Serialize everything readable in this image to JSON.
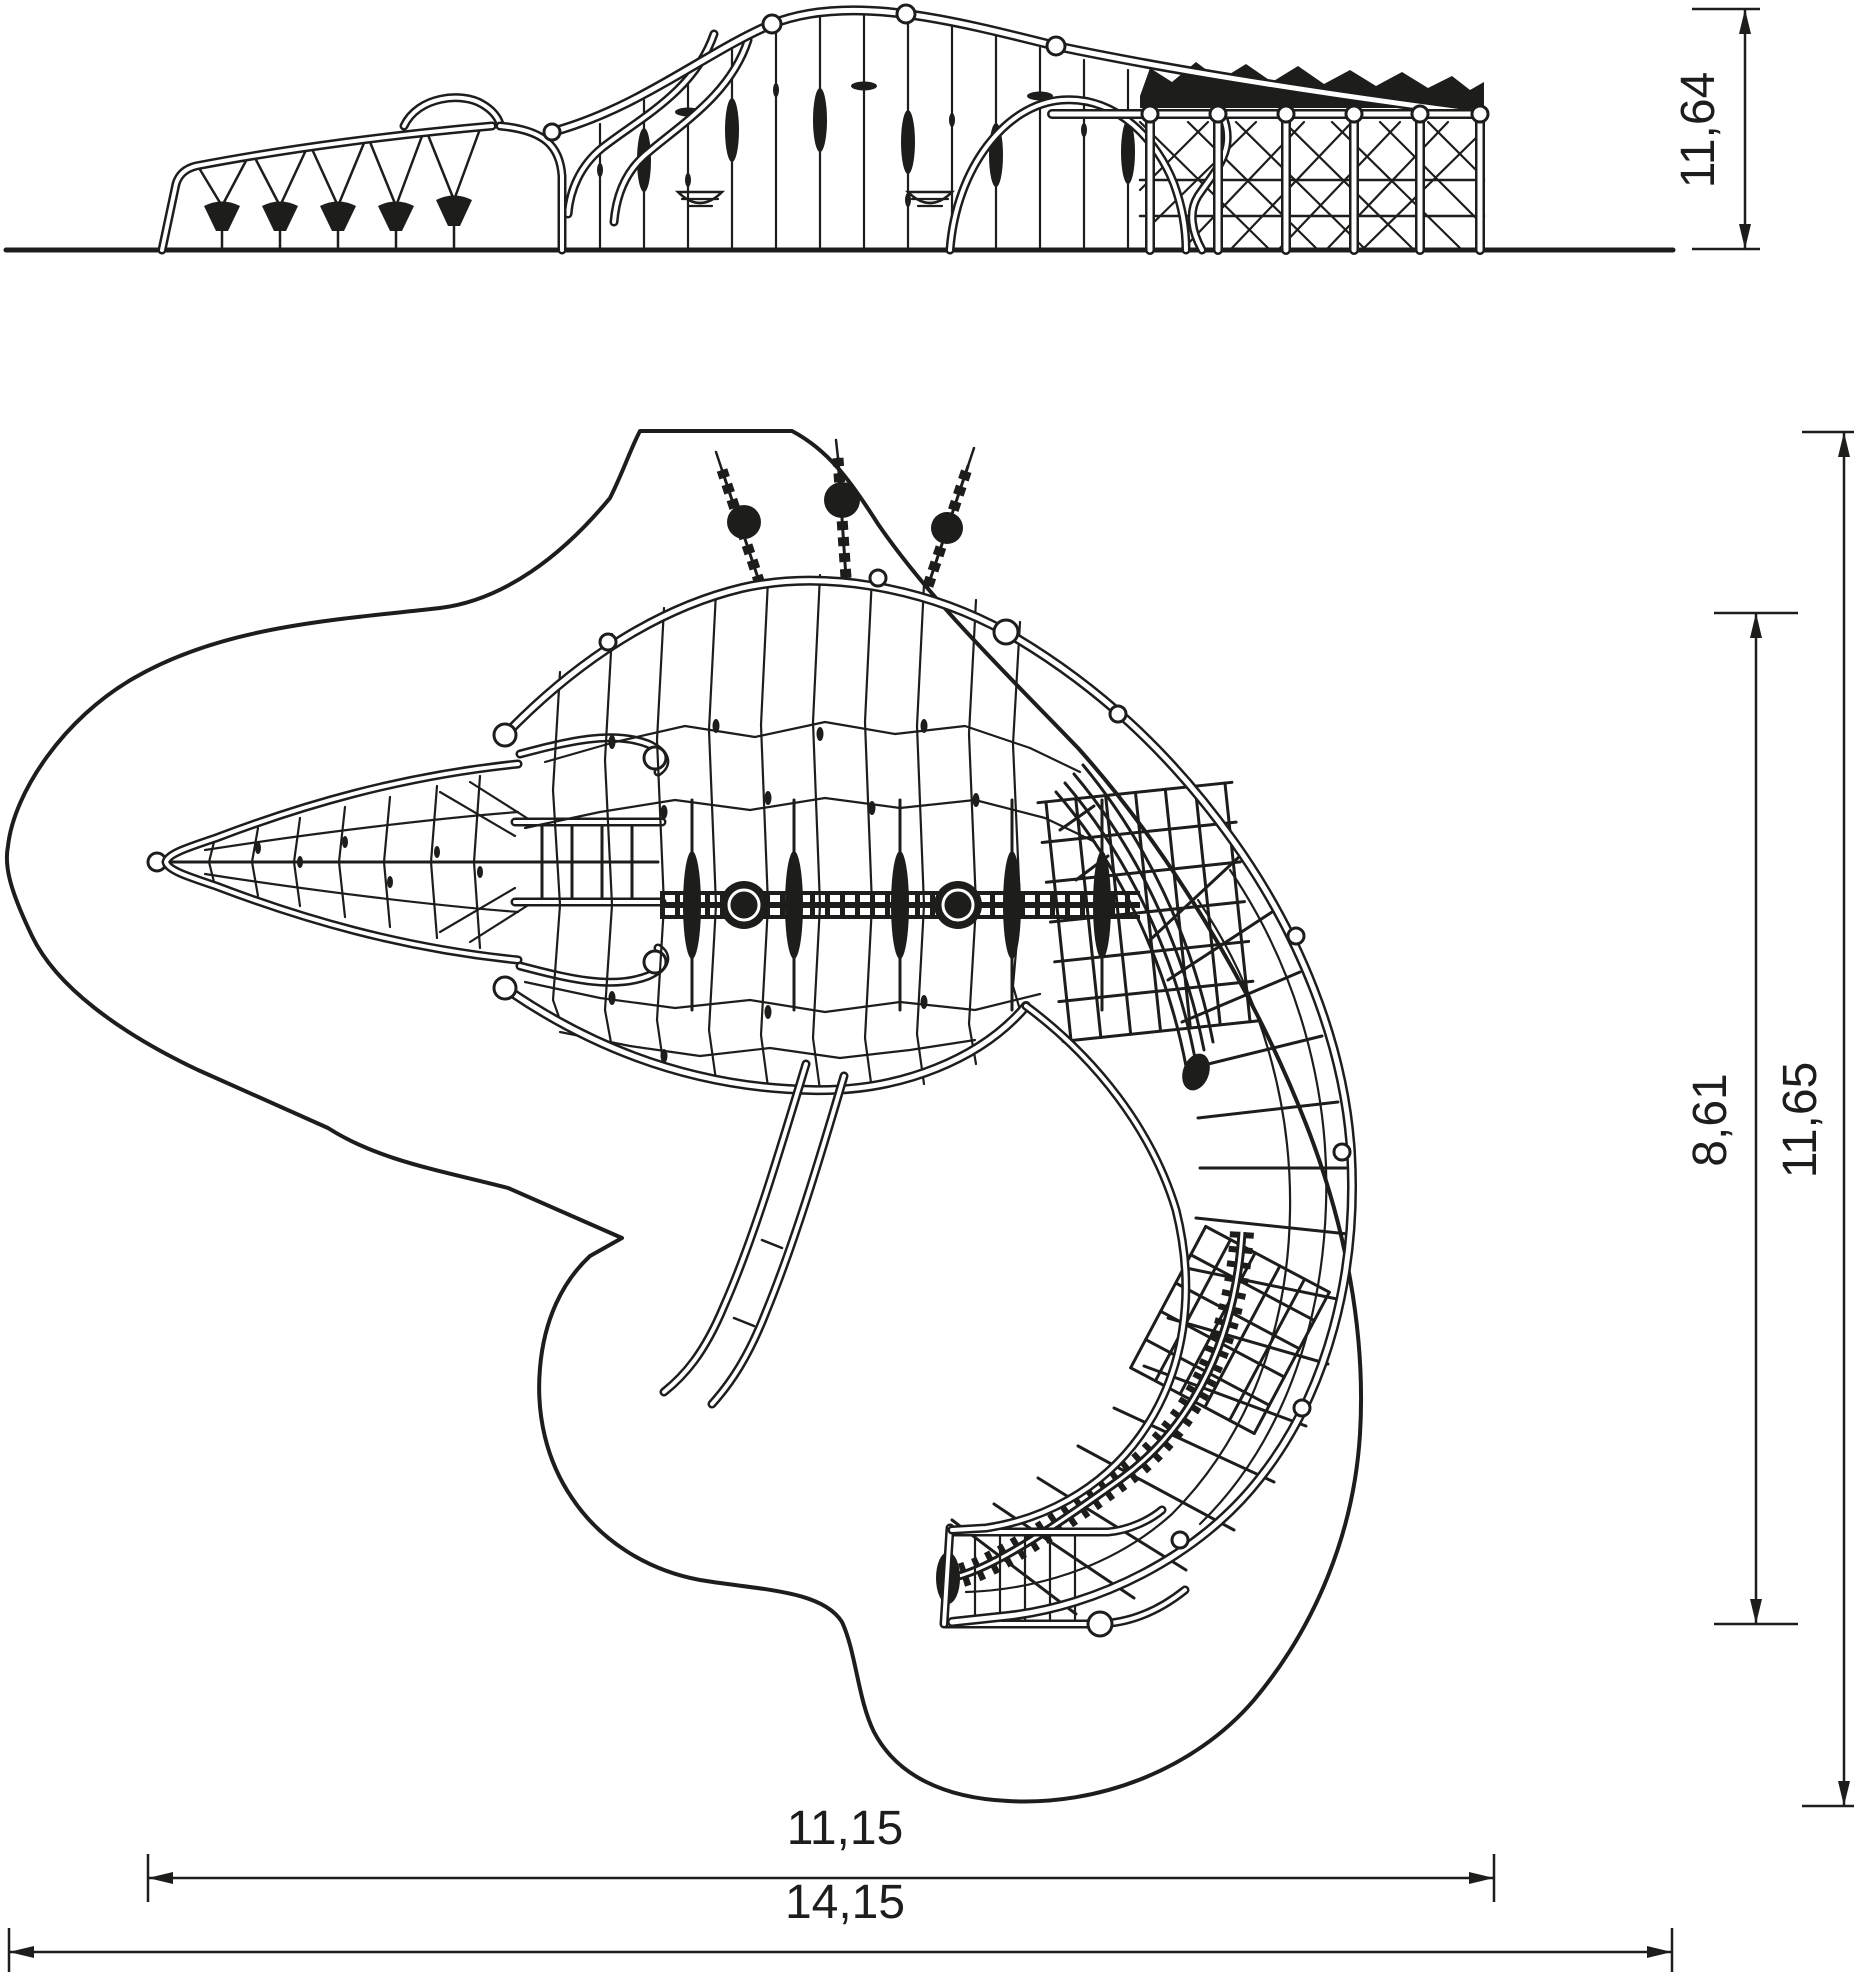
{
  "page": {
    "background": "#ffffff",
    "stroke_color": "#1d1d1b",
    "content": "technical drawing of crocodile-shaped rope climbing playground structure, side elevation and plan view"
  },
  "dimensions": {
    "side_height": {
      "label": "11,64",
      "orientation": "vertical"
    },
    "plan_structure_depth": {
      "label": "8,61",
      "orientation": "vertical"
    },
    "plan_total_depth": {
      "label": "11,65",
      "orientation": "vertical"
    },
    "side_structure_width": {
      "label": "11,15",
      "orientation": "horizontal"
    },
    "side_total_width": {
      "label": "14,15",
      "orientation": "horizontal"
    }
  }
}
